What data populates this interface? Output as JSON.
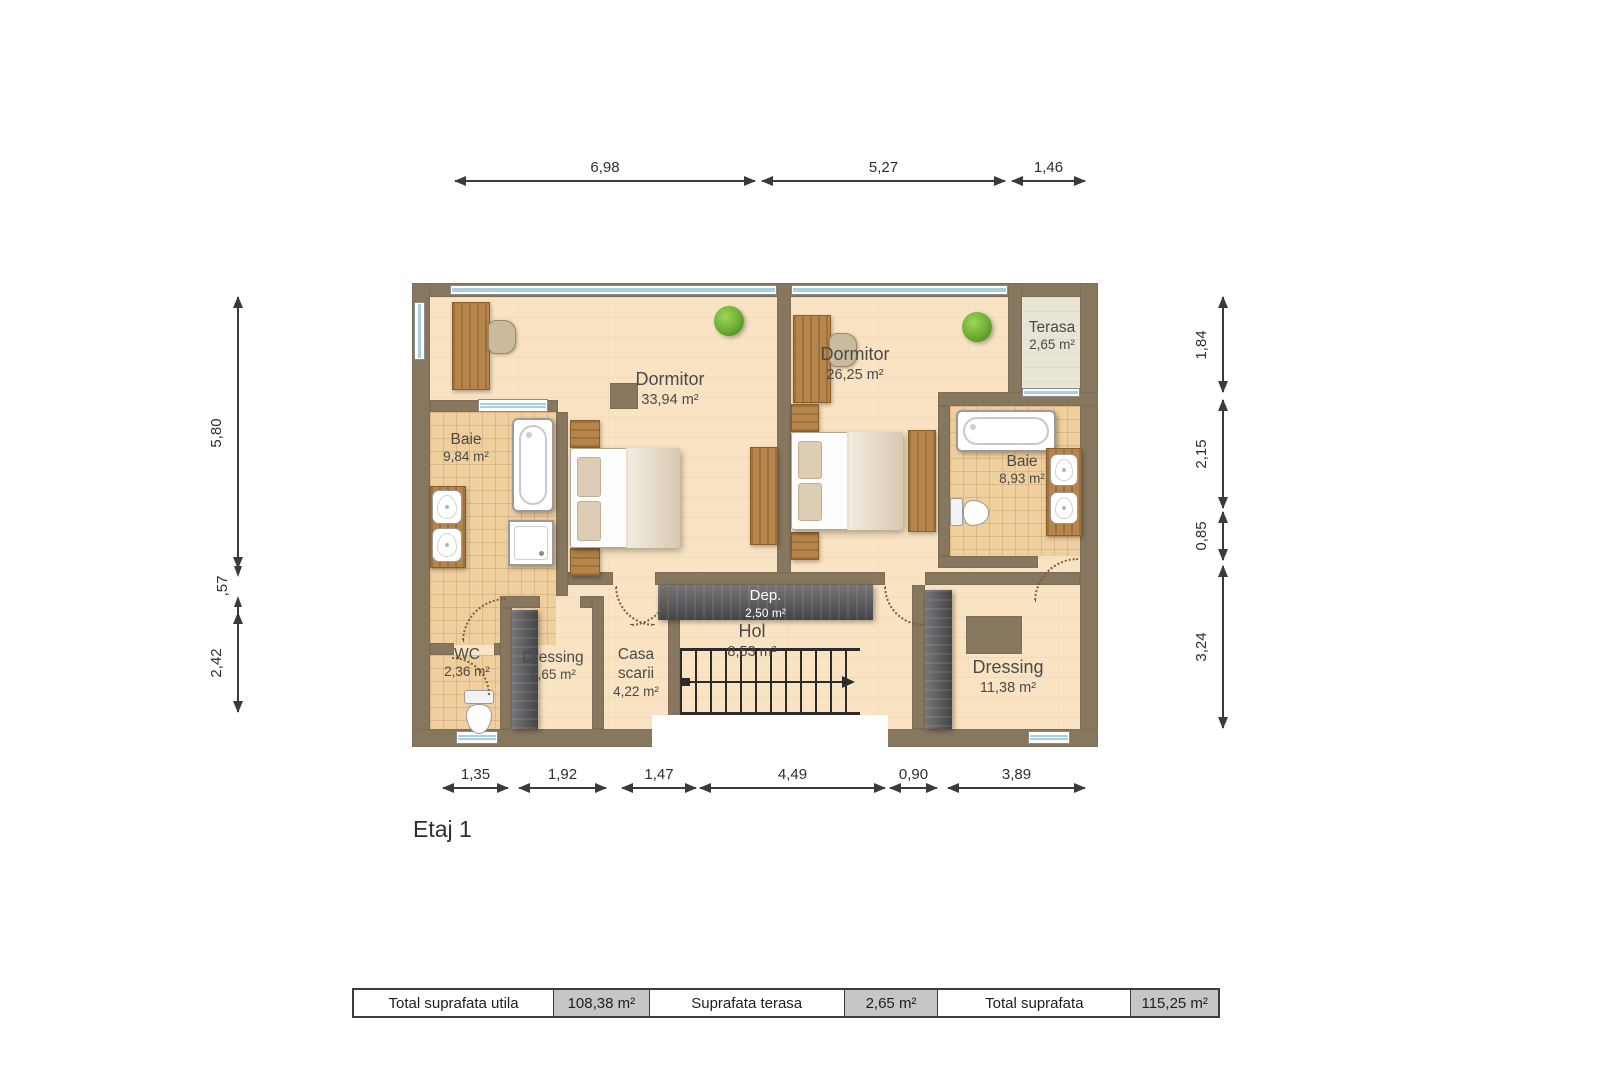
{
  "page": {
    "floor_label": "Etaj 1"
  },
  "plan": {
    "rooms": {
      "dormitor1": {
        "name": "Dormitor",
        "area": "33,94 m²"
      },
      "dormitor2": {
        "name": "Dormitor",
        "area": "26,25 m²"
      },
      "terasa": {
        "name": "Terasa",
        "area": "2,65 m²"
      },
      "baie1": {
        "name": "Baie",
        "area": "9,84 m²"
      },
      "baie2": {
        "name": "Baie",
        "area": "8,93 m²"
      },
      "wc": {
        "name": "WC",
        "area": "2,36 m²"
      },
      "dressing1": {
        "name": "Dressing",
        "area": "4,65 m²"
      },
      "casa_scarii": {
        "name": "Casa scarii",
        "area": "4,22 m²"
      },
      "hol": {
        "name": "Hol",
        "area": "8,53 m²"
      },
      "dep": {
        "name": "Dep.",
        "area": "2,50 m²"
      },
      "dressing2": {
        "name": "Dressing",
        "area": "11,38 m²"
      }
    },
    "dimensions": {
      "top": [
        "6,98",
        "5,27",
        "1,46"
      ],
      "left": [
        "5,80",
        ",57",
        "2,42"
      ],
      "right": [
        "1,84",
        "2,15",
        "0,85",
        "3,24"
      ],
      "bottom": [
        "1,35",
        "1,92",
        "1,47",
        "4,49",
        "0,90",
        "3,89"
      ]
    }
  },
  "summary_table": {
    "cells": [
      {
        "text": "Total suprafata utila",
        "type": "label"
      },
      {
        "text": "108,38 m²",
        "type": "value"
      },
      {
        "text": "Suprafata terasa",
        "type": "label"
      },
      {
        "text": "2,65 m²",
        "type": "value"
      },
      {
        "text": "Total suprafata",
        "type": "label"
      },
      {
        "text": "115,25 m²",
        "type": "value"
      }
    ]
  },
  "colors": {
    "wall": "#87775f",
    "floor": "#f9e3c2",
    "tile": "#f0cf9f",
    "terrace": "#e9e5d6",
    "closet": "#57565a",
    "dimension": "#3a3a3a",
    "table_value_bg": "#c6c6c6"
  }
}
